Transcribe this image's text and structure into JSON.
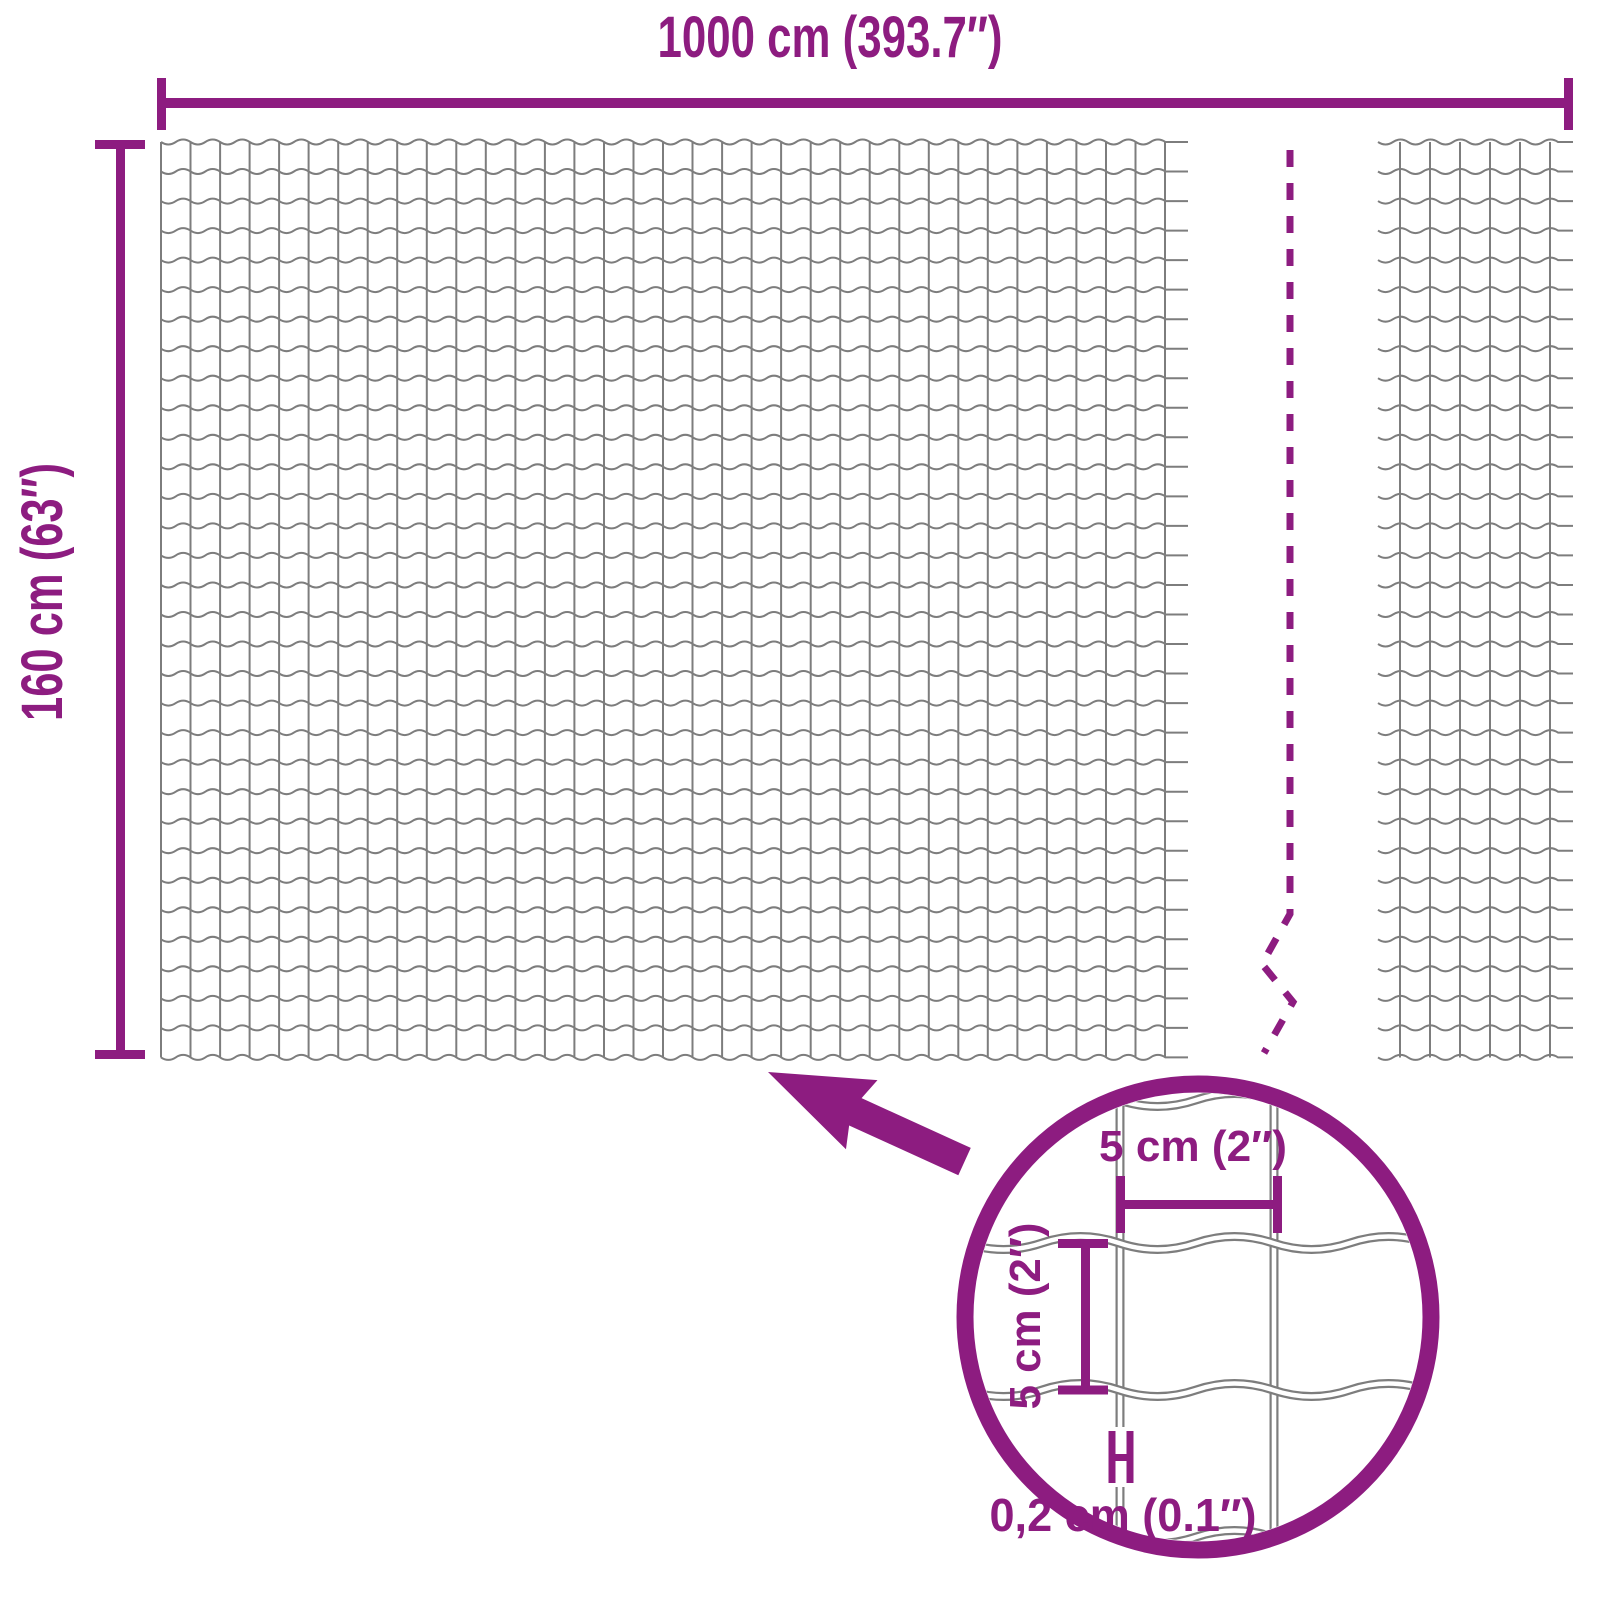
{
  "diagram": {
    "labels": {
      "total_width": "1000 cm (393.7″)",
      "total_height": "160 cm (63″)",
      "mesh_width": "5 cm (2″)",
      "mesh_height": "5 cm (2″)",
      "wire_thickness": "0,2 cm (0.1″)"
    },
    "colors": {
      "accent": "#8d1c80",
      "wire": "#7d7d7d",
      "background": "#ffffff"
    },
    "icons": {
      "zoom_arrow": "arrow-pointing-up-left",
      "magnifier": "circle-lens",
      "mesh_break": "dashed-zigzag-line",
      "thickness_marker": "h-bar-caliper"
    }
  }
}
